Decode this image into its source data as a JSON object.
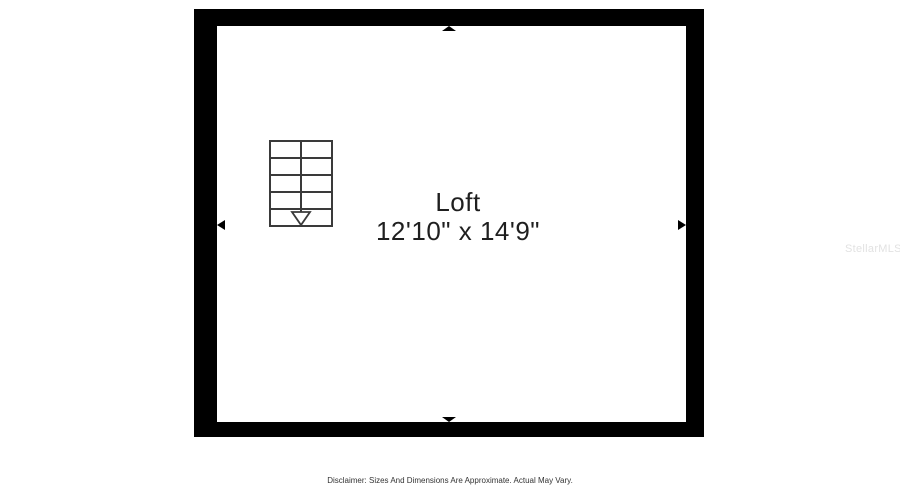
{
  "page": {
    "background": "#ffffff"
  },
  "floor_plan": {
    "room": {
      "name": "Loft",
      "dimensions": "12'10\" x 14'9\""
    },
    "stairs": {
      "steps": 5,
      "arrow_direction": "down"
    },
    "colors": {
      "wall": "#000000",
      "stair_line": "#3a3a3a",
      "label_text": "#1f1f1f"
    }
  },
  "watermark": {
    "text": "StellarMLS",
    "color": "#e2e2e2"
  },
  "footer": {
    "disclaimer": "Disclaimer: Sizes And Dimensions Are Approximate. Actual May Vary.",
    "color": "#333333"
  }
}
